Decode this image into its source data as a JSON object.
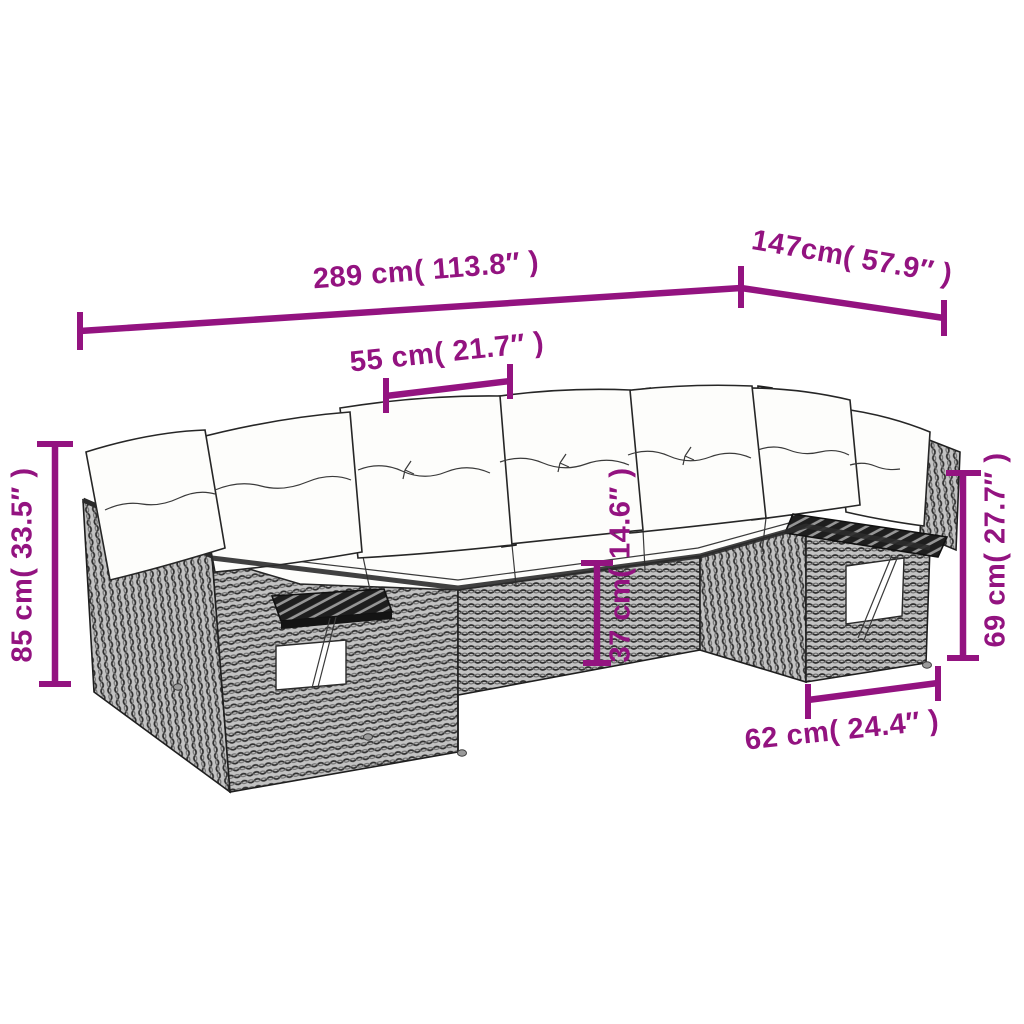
{
  "diagram": {
    "type": "product-dimension-diagram",
    "dimensions": {
      "total_width": {
        "label": "289 cm( 113.8″ )"
      },
      "total_depth": {
        "label": "147cm( 57.9″ )"
      },
      "seat_width": {
        "label": "55 cm( 21.7″ )"
      },
      "total_height": {
        "label": "85 cm( 33.5″ )"
      },
      "seat_height": {
        "label": "37 cm( 14.6″ )"
      },
      "armrest_height": {
        "label": "69 cm( 27.7″ )"
      },
      "side_section_depth": {
        "label": "62 cm( 24.4″ )"
      }
    }
  },
  "colors": {
    "dimension": "#931380",
    "background": "#ffffff",
    "outline": "#1f1f1f",
    "rattan_light": "#c2c2c2",
    "rattan_mid": "#6e6e6e",
    "rattan_dark": "#2f2f2f",
    "cushion": "#fdfdfb",
    "wood_dark": "#1e1e1e",
    "wood_light": "#969696"
  }
}
